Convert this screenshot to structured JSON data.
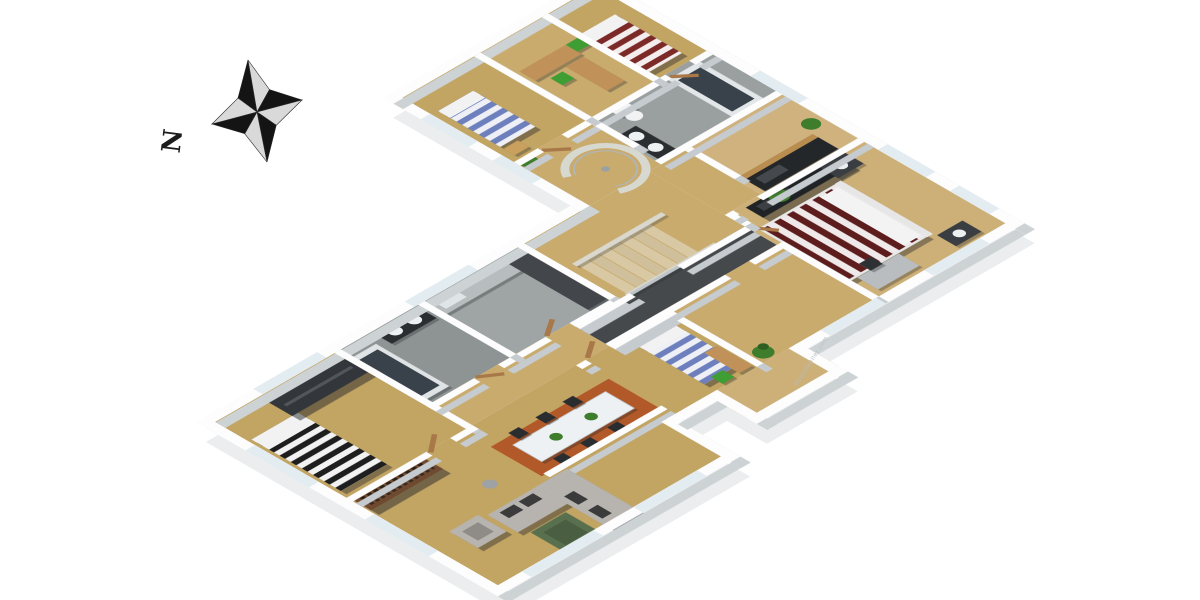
{
  "title": "3D isometric floor plan rendering",
  "compass": {
    "label": "N"
  },
  "watermark": {
    "text": "floorplanner.com"
  },
  "palette": {
    "background": "#ffffff",
    "shadow": "#ebedee",
    "wall_top": "#fdfdfd",
    "wall_side": "#c6cbcf",
    "window": "#e3ecf0",
    "floor_wood": "#c2a463",
    "floor_wood_light": "#cdb077",
    "floor_hall": "#c9ab6e",
    "tile_light": "#9fa5a5",
    "tile_dark": "#8e9394",
    "corridor_dark": "#45494c",
    "glass": "#d9e0e3",
    "rug_rust": "#b2592a",
    "sofa_gray": "#b7b4af",
    "cushion_dark": "#3b3b3b",
    "coffee_table_green": "#59704f",
    "dining_table_white": "#edf1f3",
    "chair_black": "#2a2d2f",
    "bed_linen_white": "#f2f2f2",
    "stripe_black": "#1e1e1e",
    "stripe_blue": "#6d80bd",
    "stripe_red": "#7c2a28",
    "stripe_maroon": "#5e1d1d",
    "wood_furniture": "#c09158",
    "wardrobe_dark": "#33363a",
    "bookcase_brown": "#6f4a30",
    "media_black": "#202326",
    "counter_gray": "#b7bcbe",
    "cabinet_dark": "#43474b",
    "counter_black": "#24272a",
    "tub_dark": "#39424a",
    "fixture_white": "#eef1f2",
    "plant_green": "#3e7d2c",
    "door_brown": "#a87848",
    "stair_wood": "#d8c8a4",
    "desk_gray": "#b9bdc0",
    "star_dark": "#141414",
    "star_light": "#d9d9d9",
    "ink": "#1c1c1c",
    "watermark_gray": "#b6bdc2"
  },
  "rooms": [
    {
      "id": "bedroom-southwest",
      "floor": "wood",
      "furniture": [
        "double-bed-black-white-striped",
        "dark-wardrobe"
      ]
    },
    {
      "id": "bathroom-left",
      "floor": "dark-tile",
      "furniture": [
        "bathtub",
        "black-vanity-two-basins"
      ]
    },
    {
      "id": "kitchen-utility",
      "floor": "gray-tile",
      "furniture": [
        "counter-with-sink",
        "tall-dark-cabinets"
      ]
    },
    {
      "id": "living-room",
      "floor": "wood",
      "furniture": [
        "corner-sofa",
        "armchair",
        "green-coffee-table",
        "bookcase",
        "floor-lamp",
        "dining-table-six-chairs",
        "rust-rug"
      ]
    },
    {
      "id": "middle-bedroom",
      "floor": "wood",
      "furniture": [
        "single-bed-blue-striped",
        "desk",
        "green-chair",
        "nightstand",
        "plant"
      ]
    },
    {
      "id": "entry-hall",
      "floor": "wood",
      "furniture": [
        "front-door"
      ]
    },
    {
      "id": "hallway-dark-corridor",
      "floor": "dark",
      "furniture": []
    },
    {
      "id": "stair-landing",
      "floor": "wood",
      "furniture": [
        "staircase-glass-balustrade",
        "spiral-glass-enclosure"
      ]
    },
    {
      "id": "master-bedroom",
      "floor": "light-wood",
      "furniture": [
        "double-bed-maroon-striped",
        "two-nightstands-with-lamps",
        "black-media-unit",
        "desk",
        "plant"
      ]
    },
    {
      "id": "kitchen-main",
      "floor": "light-wood",
      "furniture": [
        "black-counter-with-cooktop",
        "wood-bar-top"
      ]
    },
    {
      "id": "bathroom-top",
      "floor": "gray-tile",
      "furniture": [
        "bathtub",
        "toilet",
        "black-vanity-two-basins"
      ]
    },
    {
      "id": "bedroom-top-left",
      "floor": "wood",
      "furniture": [
        "single-bed-blue-striped",
        "nightstand"
      ]
    },
    {
      "id": "office",
      "floor": "wood",
      "furniture": [
        "two-desks",
        "two-green-chairs"
      ]
    },
    {
      "id": "bedroom-top-right",
      "floor": "wood",
      "furniture": [
        "double-bed-red-striped"
      ]
    }
  ]
}
